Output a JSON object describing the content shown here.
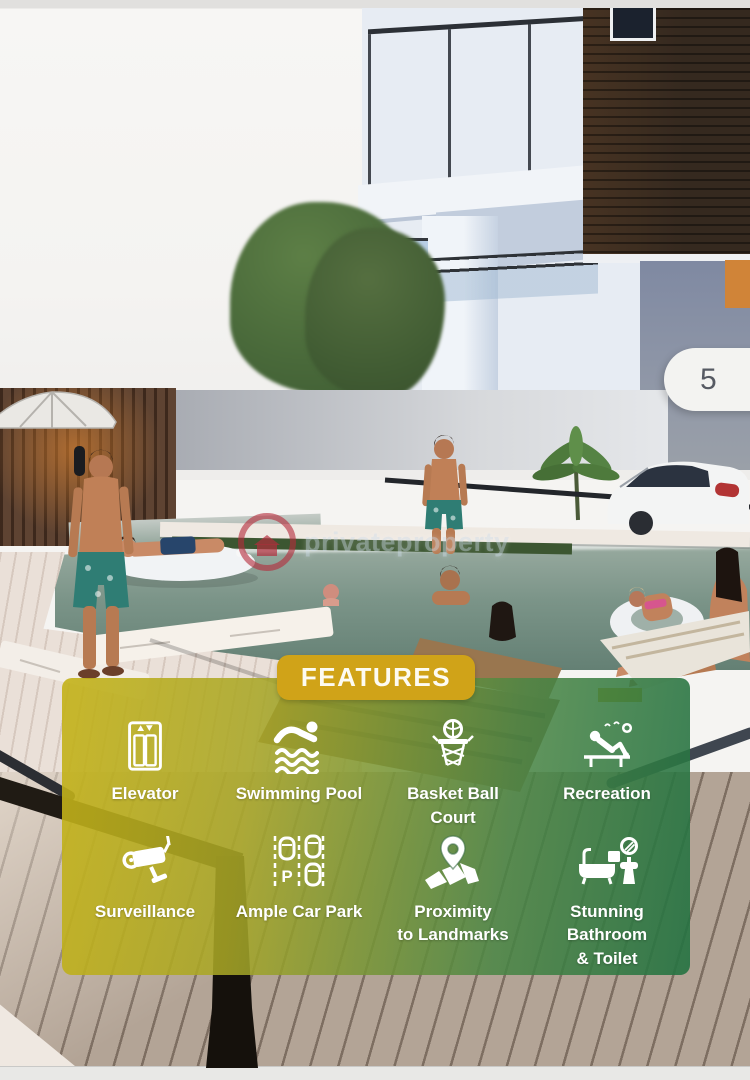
{
  "photo_counter": {
    "value": "5"
  },
  "watermark": {
    "text": "privateproperty",
    "logo_color": "#b42c3c"
  },
  "features": {
    "title": "FEATURES",
    "items": [
      {
        "label": "Elevator",
        "line1": "Elevator",
        "line2": "",
        "icon": "elevator-icon"
      },
      {
        "label": "Swimming Pool",
        "line1": "Swimming Pool",
        "line2": "",
        "icon": "swimming-pool-icon"
      },
      {
        "label": "Basket Ball Court",
        "line1": "Basket Ball",
        "line2": "Court",
        "icon": "basketball-court-icon"
      },
      {
        "label": "Recreation",
        "line1": "Recreation",
        "line2": "",
        "icon": "recreation-icon"
      },
      {
        "label": "Surveillance",
        "line1": "Surveillance",
        "line2": "",
        "icon": "surveillance-icon"
      },
      {
        "label": "Ample Car Park",
        "line1": "Ample Car Park",
        "line2": "",
        "icon": "car-park-icon"
      },
      {
        "label": "Proximity to Landmarks",
        "line1": "Proximity",
        "line2": "to Landmarks",
        "icon": "landmarks-icon"
      },
      {
        "label": "Stunning Bathroom & Toilet",
        "line1": "Stunning Bathroom",
        "line2": "& Toilet",
        "icon": "bathroom-icon"
      }
    ]
  },
  "colors": {
    "accent_gold": "#d0a318",
    "panel_gradient_start": "#c4b218",
    "panel_gradient_end": "#247242",
    "counter_background": "#f3f3f1",
    "counter_text": "#565a63",
    "watermark_red": "#b42c3c",
    "label_text": "#ffffff"
  }
}
